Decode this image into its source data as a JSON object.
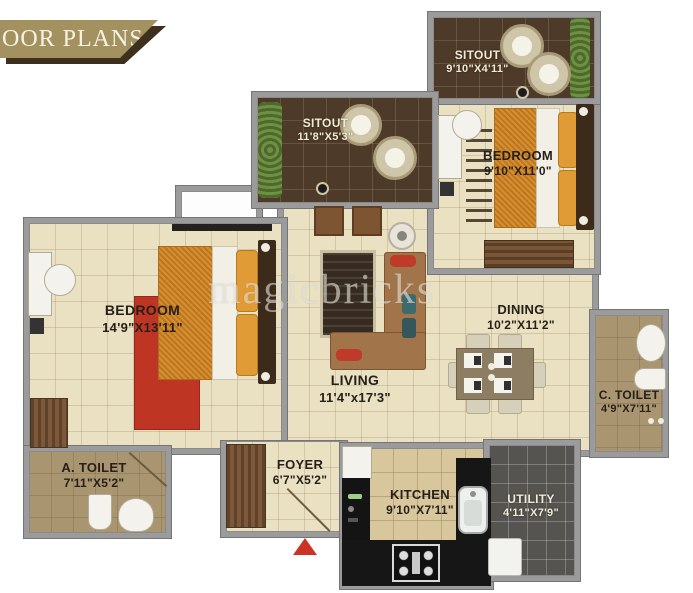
{
  "banner": {
    "text": "OOR PLANS"
  },
  "watermark": "magicbricks",
  "rooms": {
    "sitout_top": {
      "name": "SITOUT",
      "dims": "9'10\"X4'11\""
    },
    "sitout_left": {
      "name": "SITOUT",
      "dims": "11'8\"X5'3\""
    },
    "bedroom_right": {
      "name": "BEDROOM",
      "dims": "9'10\"X11'0\""
    },
    "bedroom_left": {
      "name": "BEDROOM",
      "dims": "14'9\"X13'11\""
    },
    "living": {
      "name": "LIVING",
      "dims": "11'4\"x17'3\""
    },
    "dining": {
      "name": "DINING",
      "dims": "10'2\"X11'2\""
    },
    "c_toilet": {
      "name": "C. TOILET",
      "dims": "4'9\"X7'11\""
    },
    "a_toilet": {
      "name": "A. TOILET",
      "dims": "7'11\"X5'2\""
    },
    "foyer": {
      "name": "FOYER",
      "dims": "6'7\"X5'2\""
    },
    "kitchen": {
      "name": "KITCHEN",
      "dims": "9'10\"X7'11\""
    },
    "utility": {
      "name": "UTILITY",
      "dims": "4'11\"X7'9\""
    }
  },
  "colors": {
    "banner_tan": "#a39260",
    "banner_shadow": "#3f2f1f",
    "wall_gray": "#9b9b9b",
    "floor_cream": "#e9e1c2",
    "sitout_brown": "#4e3a28",
    "bed_orange": "#d68f2e",
    "accent_red": "#cc3226",
    "counter_black": "#161616"
  }
}
